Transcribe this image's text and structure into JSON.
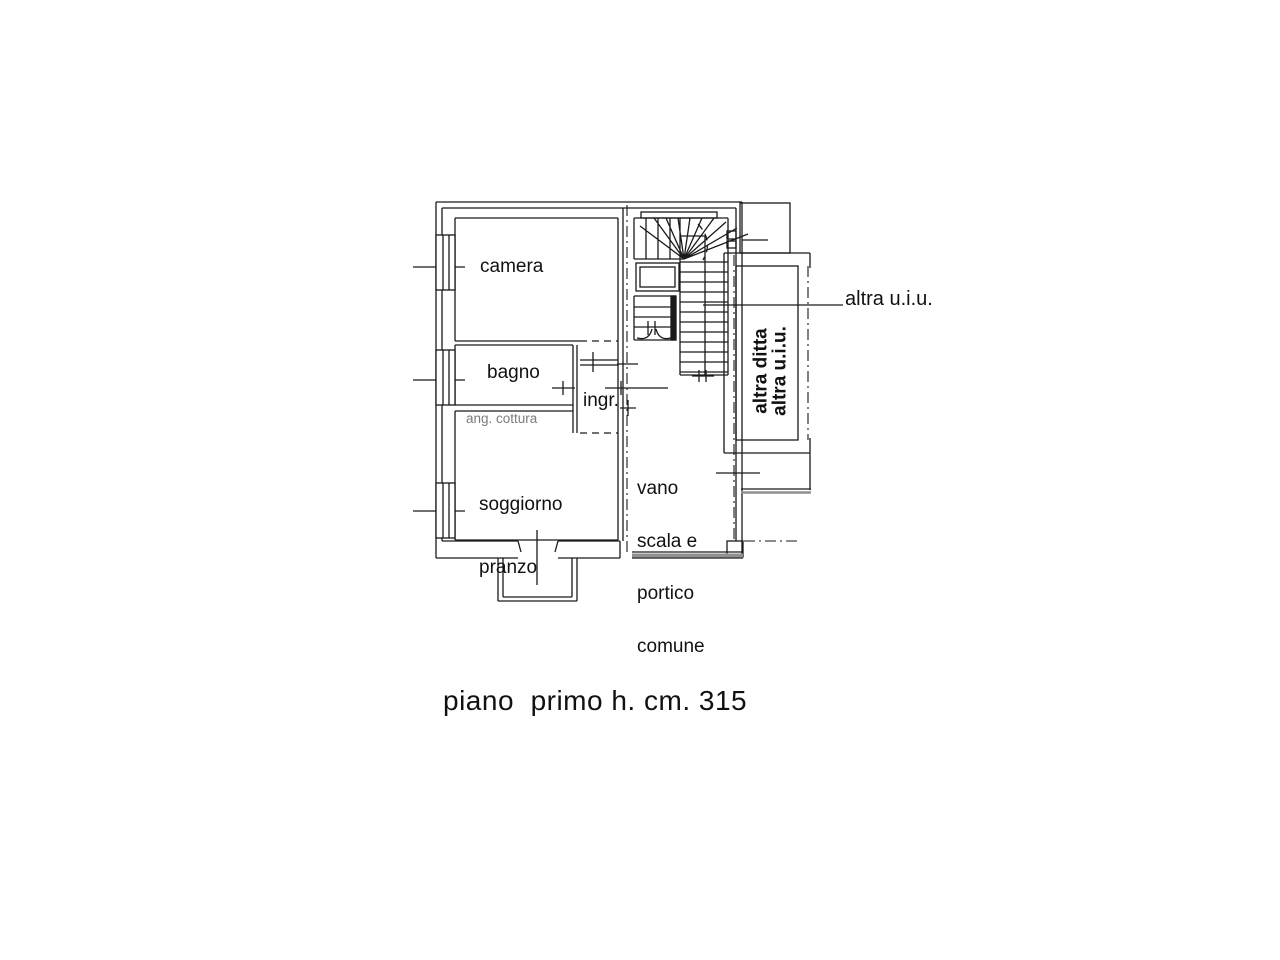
{
  "drawing": {
    "type": "floor-plan",
    "caption": "piano  primo h. cm. 315",
    "rooms": {
      "camera": {
        "label": "camera"
      },
      "bagno": {
        "label": "bagno"
      },
      "ingresso": {
        "label": "ingr."
      },
      "angolo_cottura": {
        "label": "ang. cottura"
      },
      "soggiorno_pranzo": {
        "lines": [
          "soggiorno",
          "pranzo"
        ]
      },
      "vano_scala": {
        "lines": [
          "vano",
          "scala e",
          "portico",
          "comune"
        ]
      },
      "altra_ditta": {
        "lines": [
          "altra ditta",
          "altra u.i.u."
        ]
      }
    },
    "callouts": {
      "altra_uiu": "altra u.i.u."
    },
    "colors": {
      "line": "#1a1a1a",
      "gray_wall": "#909090",
      "muted_text": "#7b7b7b",
      "background": "#ffffff"
    }
  }
}
